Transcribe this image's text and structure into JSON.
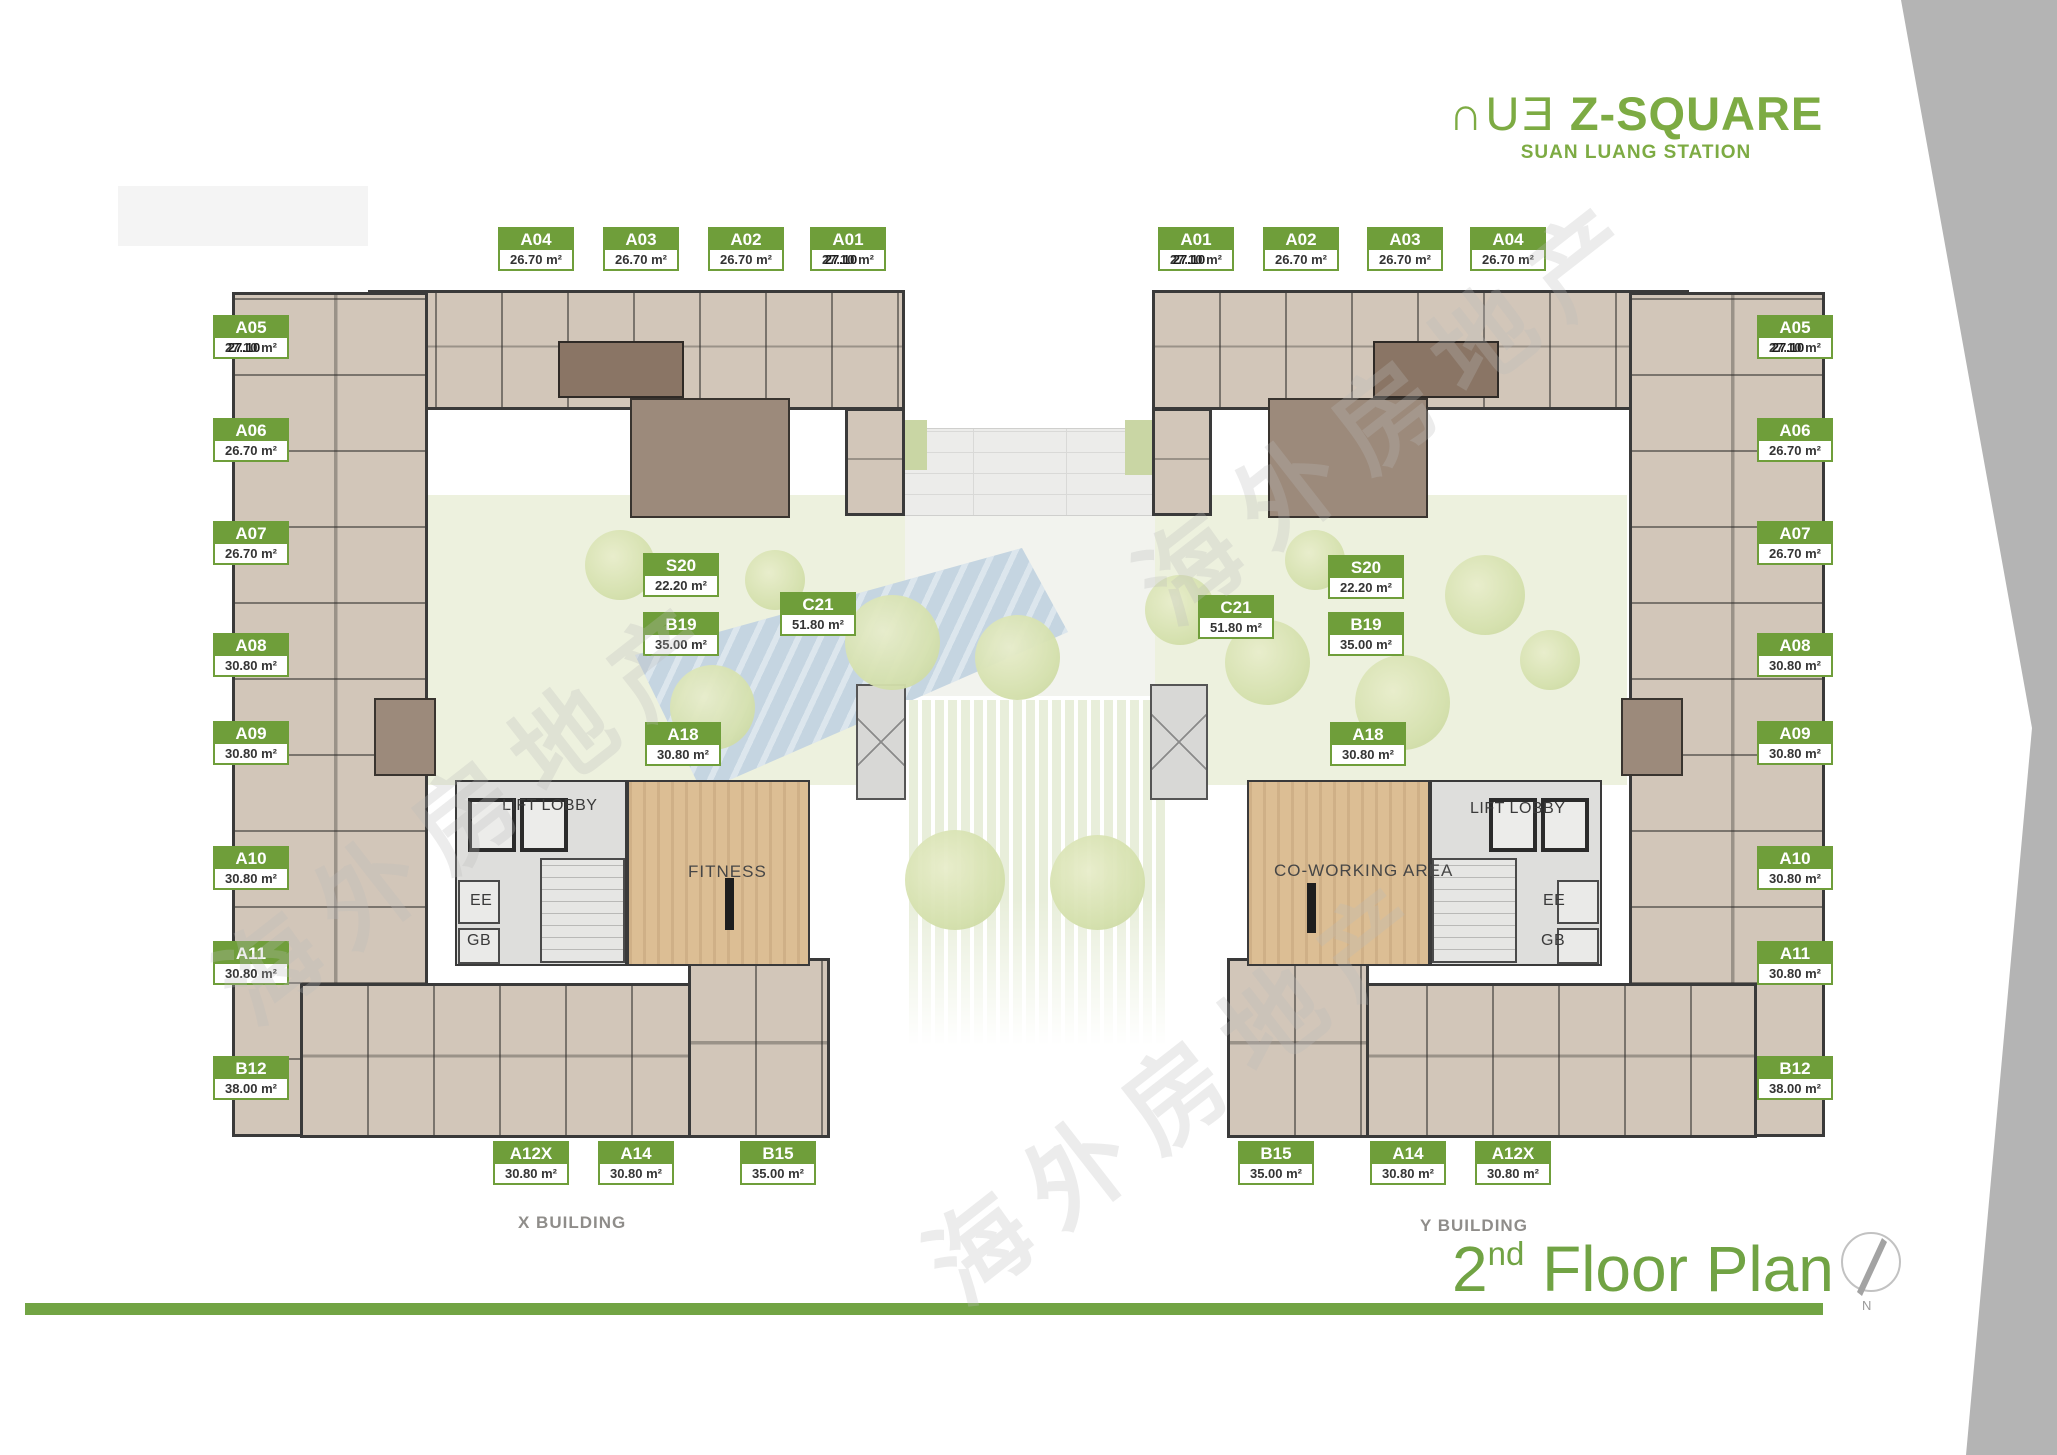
{
  "logo": {
    "brand_prefix": "∩UƎ",
    "brand_name": "Z-SQUARE",
    "subtitle": "SUAN LUANG STATION"
  },
  "title": {
    "number": "2",
    "ordinal": "nd",
    "text": "Floor Plan"
  },
  "captions": {
    "x_building": "X BUILDING",
    "y_building": "Y BUILDING"
  },
  "rooms": {
    "lift_lobby": "LIFT LOBBY",
    "fitness": "FITNESS",
    "coworking": "CO-WORKING AREA",
    "ee": "EE",
    "gb": "GB"
  },
  "compass": {
    "north": "N"
  },
  "watermark": "海外房地产",
  "colors": {
    "label_green": "#6f9e3a",
    "title_green": "#72a444",
    "gray_band": "#b4b4b4"
  },
  "units": [
    {
      "id": "A04",
      "area": "26.70 m²"
    },
    {
      "id": "A03",
      "area": "26.70 m²"
    },
    {
      "id": "A02",
      "area": "26.70 m²"
    },
    {
      "id": "A01",
      "area": "27.10 m²",
      "overlay": "27.10"
    },
    {
      "id": "A01",
      "area": "27.10 m²",
      "overlay": "27.10"
    },
    {
      "id": "A02",
      "area": "26.70 m²"
    },
    {
      "id": "A03",
      "area": "26.70 m²"
    },
    {
      "id": "A04",
      "area": "26.70 m²"
    },
    {
      "id": "A05",
      "area": "27.10 m²",
      "overlay": "27.10"
    },
    {
      "id": "A06",
      "area": "26.70 m²"
    },
    {
      "id": "A07",
      "area": "26.70 m²"
    },
    {
      "id": "A08",
      "area": "30.80 m²"
    },
    {
      "id": "A09",
      "area": "30.80 m²"
    },
    {
      "id": "A10",
      "area": "30.80 m²"
    },
    {
      "id": "A11",
      "area": "30.80 m²"
    },
    {
      "id": "B12",
      "area": "38.00 m²"
    },
    {
      "id": "A05",
      "area": "27.10 m²",
      "overlay": "27.10"
    },
    {
      "id": "A06",
      "area": "26.70 m²"
    },
    {
      "id": "A07",
      "area": "26.70 m²"
    },
    {
      "id": "A08",
      "area": "30.80 m²"
    },
    {
      "id": "A09",
      "area": "30.80 m²"
    },
    {
      "id": "A10",
      "area": "30.80 m²"
    },
    {
      "id": "A11",
      "area": "30.80 m²"
    },
    {
      "id": "B12",
      "area": "38.00 m²"
    },
    {
      "id": "S20",
      "area": "22.20 m²"
    },
    {
      "id": "B19",
      "area": "35.00 m²"
    },
    {
      "id": "C21",
      "area": "51.80 m²"
    },
    {
      "id": "A18",
      "area": "30.80 m²"
    },
    {
      "id": "C21",
      "area": "51.80 m²"
    },
    {
      "id": "S20",
      "area": "22.20 m²"
    },
    {
      "id": "B19",
      "area": "35.00 m²"
    },
    {
      "id": "A18",
      "area": "30.80 m²"
    },
    {
      "id": "A12X",
      "area": "30.80 m²"
    },
    {
      "id": "A14",
      "area": "30.80 m²"
    },
    {
      "id": "B15",
      "area": "35.00 m²"
    },
    {
      "id": "B15",
      "area": "35.00 m²"
    },
    {
      "id": "A14",
      "area": "30.80 m²"
    },
    {
      "id": "A12X",
      "area": "30.80 m²"
    }
  ]
}
